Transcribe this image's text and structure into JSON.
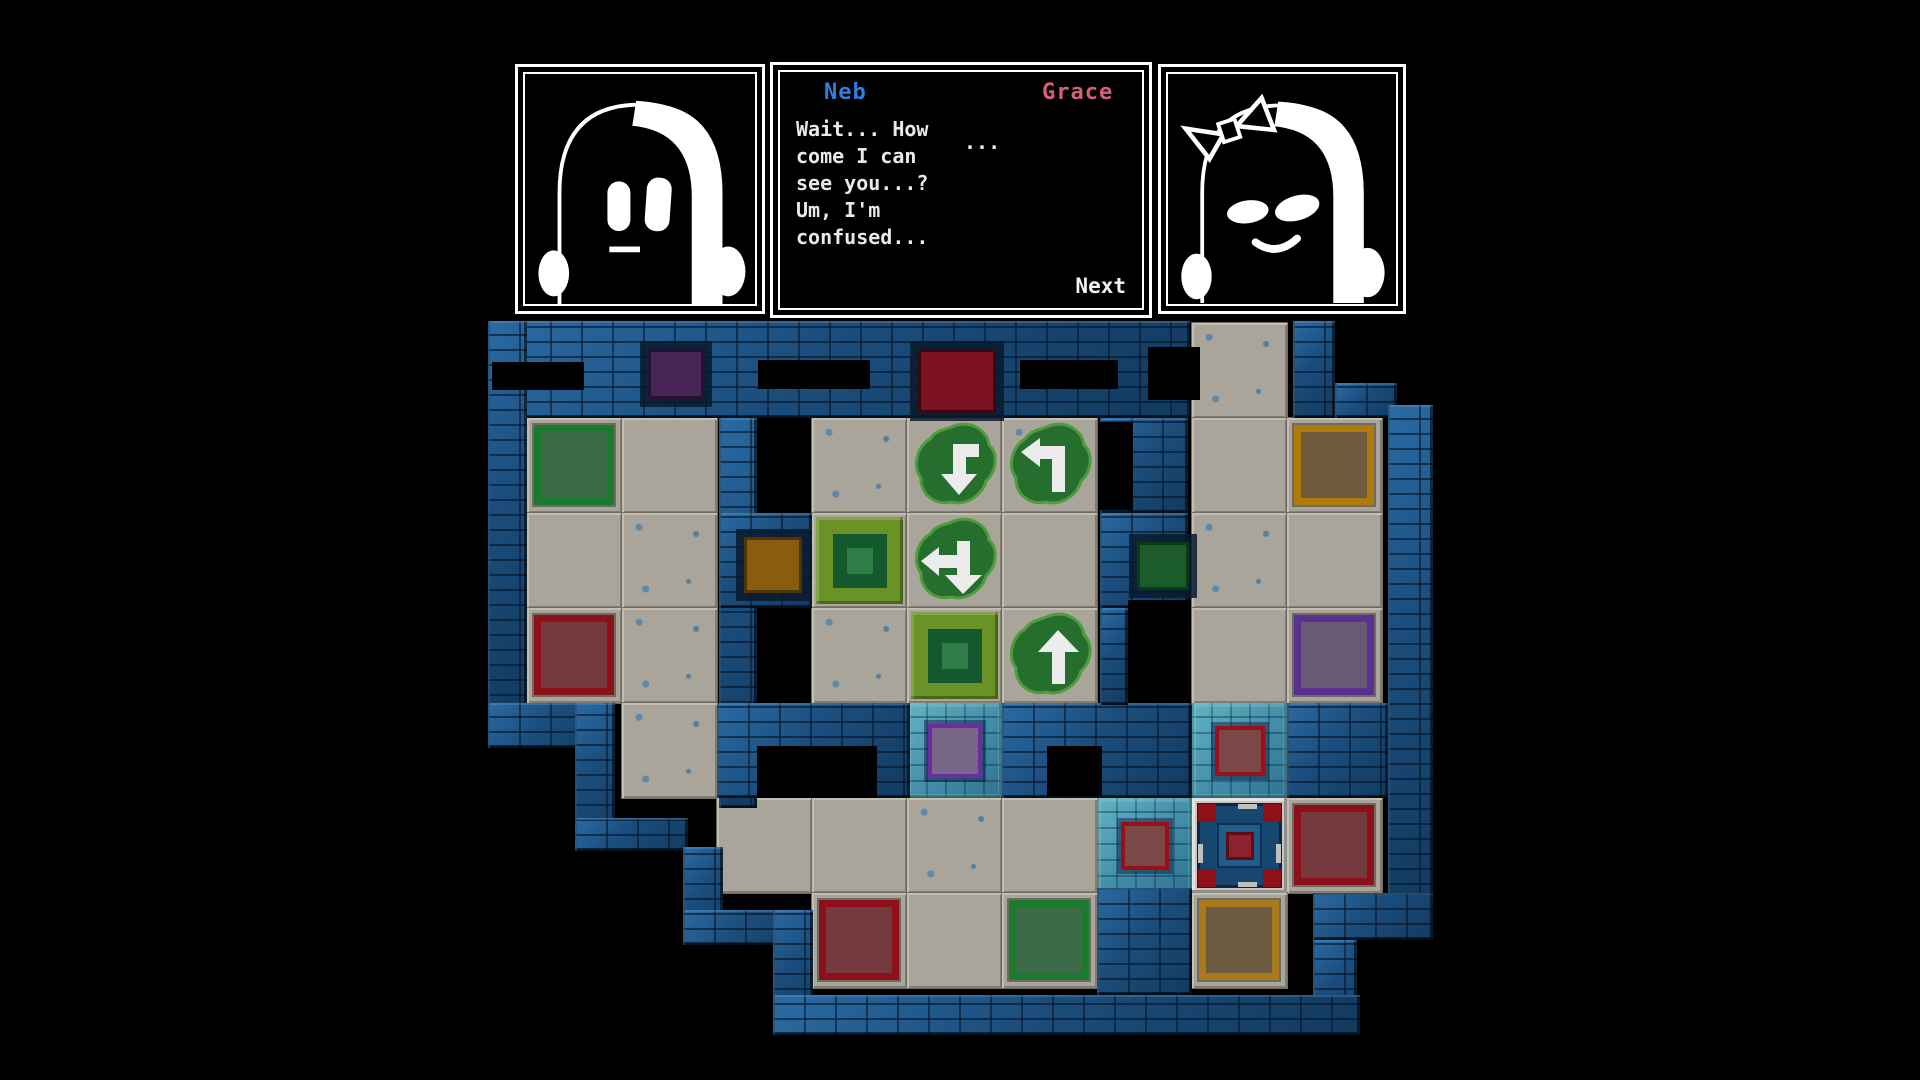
{
  "dialogue": {
    "left_character": "Neb",
    "right_character": "Grace",
    "lines": [
      "Wait... How",
      "come I can",
      "see you...?",
      "Um, I'm",
      "confused..."
    ],
    "ellipsis": "...",
    "next_label": "Next"
  },
  "palette": {
    "name_blue": "#2f7de1",
    "name_pink": "#d85f77",
    "piece_green_border": "#1a7a2d",
    "piece_green_fill": "#3e6b47",
    "piece_red_border": "#8e1119",
    "piece_red_fill": "#753a3e",
    "piece_orange_border": "#b07b08",
    "piece_orange_fill": "#6e5a3c",
    "piece_amber_border": "#a87a1c",
    "piece_amber_fill": "#6b5a40",
    "piece_purple_border": "#5a3191",
    "piece_purple_fill": "#665a74",
    "socket_purple": "#482355",
    "socket_purple_border": "#241030",
    "socket_red": "#7c1220",
    "socket_red_border": "#3c0810",
    "socket_brown": "#8a5c10",
    "socket_brown_border": "#4e3406",
    "socket_green": "#1c5c2a",
    "socket_green_border": "#0c3a16",
    "cyan_purple_border": "#6b2da0",
    "cyan_purple_fill": "#776688",
    "cyan_red_border": "#991018",
    "cyan_red_fill": "#7a4846",
    "target_outer": "#6b9226",
    "target_mid": "#14582e",
    "target_core": "#2e7c46",
    "arrow_blob": "#256e2d",
    "arrow_blob_edge": "#4f9c3e",
    "arrow_fill": "#ececec"
  },
  "board": {
    "origin_x": 432,
    "origin_y": 323,
    "tile": 95,
    "walls": [
      [
        488,
        321,
        702,
        97
      ],
      [
        1293,
        321,
        42,
        97
      ],
      [
        1335,
        383,
        62,
        35
      ],
      [
        1388,
        405,
        45,
        495
      ],
      [
        1287,
        703,
        101,
        95
      ],
      [
        1313,
        893,
        120,
        47
      ],
      [
        1313,
        940,
        44,
        95
      ],
      [
        488,
        321,
        39,
        390
      ],
      [
        719,
        418,
        38,
        390
      ],
      [
        719,
        513,
        93,
        95
      ],
      [
        717,
        703,
        193,
        95
      ],
      [
        1002,
        703,
        190,
        95
      ],
      [
        1100,
        418,
        88,
        95
      ],
      [
        1100,
        513,
        88,
        95
      ],
      [
        1100,
        608,
        28,
        97
      ],
      [
        1097,
        888,
        95,
        107
      ],
      [
        488,
        703,
        127,
        45
      ],
      [
        575,
        703,
        40,
        148
      ],
      [
        575,
        818,
        113,
        33
      ],
      [
        683,
        847,
        40,
        98
      ],
      [
        683,
        910,
        130,
        35
      ],
      [
        773,
        910,
        40,
        125
      ],
      [
        773,
        995,
        587,
        40
      ]
    ],
    "slots": [
      [
        492,
        362,
        92,
        28
      ],
      [
        758,
        360,
        112,
        29
      ],
      [
        1020,
        360,
        98,
        29
      ],
      [
        1148,
        347,
        52,
        53
      ],
      [
        757,
        746,
        120,
        52
      ],
      [
        1047,
        746,
        55,
        50
      ],
      [
        1128,
        600,
        60,
        100
      ],
      [
        1100,
        422,
        33,
        88
      ]
    ],
    "floors": [
      [
        0,
        8
      ],
      [
        1,
        1
      ],
      [
        1,
        2
      ],
      [
        1,
        4
      ],
      [
        1,
        5
      ],
      [
        1,
        6
      ],
      [
        1,
        8
      ],
      [
        1,
        9
      ],
      [
        2,
        1
      ],
      [
        2,
        2
      ],
      [
        2,
        4
      ],
      [
        2,
        5
      ],
      [
        2,
        6
      ],
      [
        2,
        8
      ],
      [
        2,
        9
      ],
      [
        3,
        1
      ],
      [
        3,
        2
      ],
      [
        3,
        4
      ],
      [
        3,
        5
      ],
      [
        3,
        6
      ],
      [
        3,
        8
      ],
      [
        3,
        9
      ],
      [
        4,
        2
      ],
      [
        5,
        3
      ],
      [
        5,
        4
      ],
      [
        5,
        5
      ],
      [
        5,
        6
      ],
      [
        5,
        9
      ],
      [
        6,
        4
      ],
      [
        6,
        5
      ],
      [
        6,
        6
      ],
      [
        6,
        8
      ]
    ],
    "speckled": [
      [
        1,
        4
      ],
      [
        2,
        2
      ],
      [
        2,
        8
      ],
      [
        5,
        5
      ],
      [
        3,
        2
      ],
      [
        1,
        6
      ],
      [
        3,
        4
      ],
      [
        4,
        2
      ],
      [
        0,
        8
      ]
    ],
    "pieces": [
      {
        "row": 1,
        "col": 1,
        "color": "green"
      },
      {
        "row": 3,
        "col": 1,
        "color": "red"
      },
      {
        "row": 1,
        "col": 9,
        "color": "orange"
      },
      {
        "row": 3,
        "col": 9,
        "color": "purple"
      },
      {
        "row": 5,
        "col": 9,
        "color": "red"
      },
      {
        "row": 6,
        "col": 4,
        "color": "red"
      },
      {
        "row": 6,
        "col": 6,
        "color": "green"
      },
      {
        "row": 6,
        "col": 8,
        "color": "amber"
      }
    ],
    "targets": [
      [
        2,
        4
      ],
      [
        3,
        5
      ]
    ],
    "arrows": [
      {
        "row": 1,
        "col": 5,
        "dir": "turn-down"
      },
      {
        "row": 1,
        "col": 6,
        "dir": "turn-left"
      },
      {
        "row": 2,
        "col": 5,
        "dir": "left-down"
      },
      {
        "row": 3,
        "col": 6,
        "dir": "up"
      }
    ],
    "special": {
      "row": 5,
      "col": 8
    },
    "cyan_sockets": [
      {
        "row": 4,
        "col": 5,
        "color": "purple",
        "size": 46
      },
      {
        "row": 5,
        "col": 7,
        "color": "red",
        "size": 40
      },
      {
        "row": 4,
        "col": 8,
        "color": "red",
        "size": 42
      }
    ],
    "wall_sockets": [
      {
        "x": 648,
        "y": 349,
        "w": 50,
        "h": 44,
        "color": "purple"
      },
      {
        "x": 918,
        "y": 349,
        "w": 72,
        "h": 58,
        "color": "red"
      },
      {
        "x": 744,
        "y": 537,
        "w": 52,
        "h": 50,
        "color": "brown"
      },
      {
        "x": 1137,
        "y": 542,
        "w": 46,
        "h": 42,
        "color": "green"
      }
    ]
  }
}
